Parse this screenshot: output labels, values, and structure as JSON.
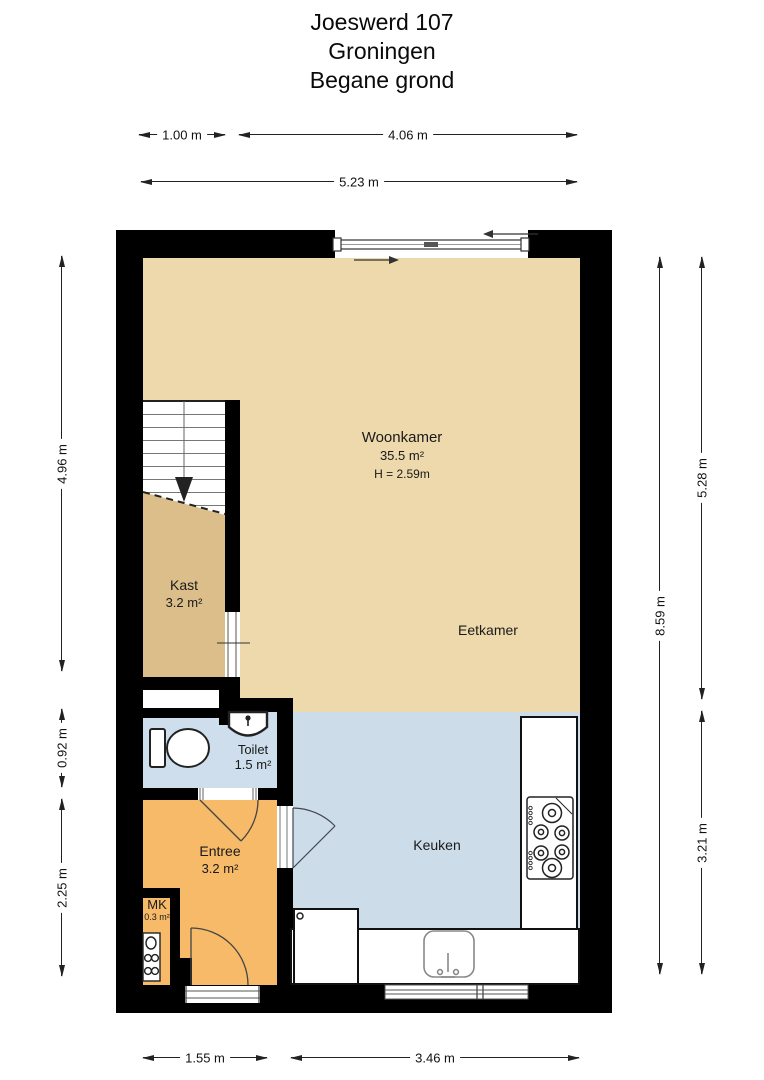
{
  "title": {
    "address": "Joeswerd 107",
    "city": "Groningen",
    "floor": "Begane grond"
  },
  "rooms": {
    "woonkamer": {
      "name": "Woonkamer",
      "area": "35.5 m²",
      "ceiling": "H = 2.59m"
    },
    "eetkamer": {
      "name": "Eetkamer"
    },
    "kast": {
      "name": "Kast",
      "area": "3.2 m²"
    },
    "toilet": {
      "name": "Toilet",
      "area": "1.5 m²"
    },
    "entree": {
      "name": "Entree",
      "area": "3.2 m²"
    },
    "mk": {
      "name": "MK",
      "area": "0.3 m²"
    },
    "keuken": {
      "name": "Keuken"
    }
  },
  "dimensions": {
    "top_segment_left": "1.00 m",
    "top_segment_right": "4.06 m",
    "top_total": "5.23 m",
    "left_upper": "4.96 m",
    "left_middle": "0.92 m",
    "left_lower": "2.25 m",
    "right_total": "8.59 m",
    "right_upper": "5.28 m",
    "right_lower": "3.21 m",
    "bottom_left": "1.55 m",
    "bottom_right": "3.46 m"
  },
  "colors": {
    "wall": "#000000",
    "woonkamer_floor": "#edd9ab",
    "kast_floor": "#dcbe8b",
    "entree_floor": "#f6ba69",
    "toilet_floor": "#cfdeec",
    "keuken_floor": "#ccdce9"
  }
}
